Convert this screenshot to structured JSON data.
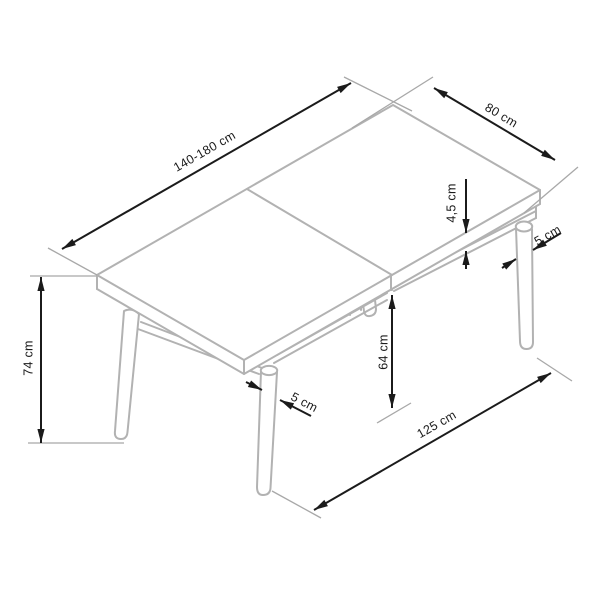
{
  "diagram": {
    "subject": "extendable-dining-table-dimension-drawing",
    "background_color": "#ffffff",
    "outline_color": "#b2b2b2",
    "dimension_color": "#1b1b1b",
    "units": "cm",
    "dimensions": [
      {
        "id": "table-length",
        "label": "140-180 cm",
        "measures": "table top length (extendable)"
      },
      {
        "id": "table-depth",
        "label": "80 cm",
        "measures": "table top depth"
      },
      {
        "id": "table-height",
        "label": "74 cm",
        "measures": "overall height"
      },
      {
        "id": "top-thickness",
        "label": "4,5 cm",
        "measures": "table top thickness"
      },
      {
        "id": "rear-leg-diameter",
        "label": "5 cm",
        "measures": "rear leg diameter"
      },
      {
        "id": "front-leg-diameter",
        "label": "5 cm",
        "measures": "front leg diameter"
      },
      {
        "id": "under-frame-clearance",
        "label": "64 cm",
        "measures": "clearance under frame"
      },
      {
        "id": "leg-span",
        "label": "125 cm",
        "measures": "distance between leg feet"
      }
    ]
  }
}
